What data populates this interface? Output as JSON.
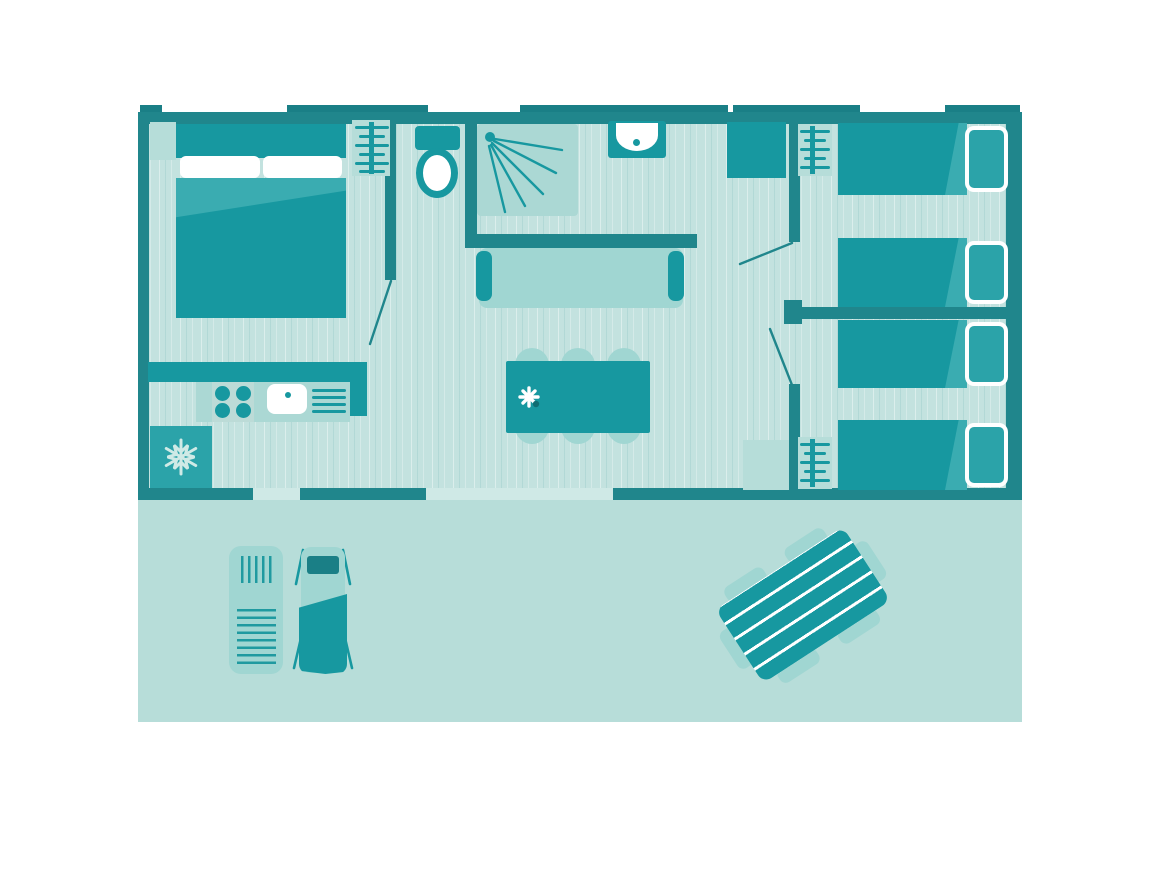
{
  "diagram_type": "mobile-home-floorplan-top-view",
  "palette": {
    "wall": "#20868c",
    "walltab": "#1a7f86",
    "furn": "#1798a0",
    "furnmed": "#2ba3a9",
    "fold": "#3aacb1",
    "light": "#a0d6d2",
    "lighter": "#b6ddd9",
    "surface": "#abd8d4",
    "stove": "#bcdbd7",
    "floor": "#c3e2df",
    "terrace": "#b7ddd9",
    "gap": "#cfe9e6",
    "stripeline": "#1f9aa0",
    "snowflake": "#cfeae6",
    "flower": "#ffffff",
    "flower_dot": "#0f6d72"
  },
  "icons": [
    "snowflake-icon",
    "shower-spray-icon",
    "flower-icon",
    "clothes-rack-icon",
    "door-swing-icon"
  ],
  "rooms": {
    "master_bedroom": [
      "double-bed",
      "nightstand",
      "clothes-rack"
    ],
    "kitchen": [
      "counter",
      "stove-burners",
      "sink",
      "drainer",
      "fridge"
    ],
    "toilet_room": [
      "toilet"
    ],
    "bathroom": [
      "shower",
      "washbasin"
    ],
    "living_room": [
      "sofa",
      "dining-table",
      "chairs",
      "flower"
    ],
    "hallway": [
      "wardrobe",
      "entry-mat"
    ],
    "kids_bedroom_1": [
      "single-bed",
      "single-bed",
      "clothes-rack",
      "wardrobe"
    ],
    "kids_bedroom_2": [
      "single-bed",
      "single-bed",
      "clothes-rack"
    ],
    "terrace": [
      "sun-lounger-slatted",
      "sun-lounger-towel",
      "picnic-table"
    ]
  },
  "counts": {
    "single_beds": 4,
    "double_beds": 1,
    "dining_chairs": 6,
    "loungers": 2
  }
}
